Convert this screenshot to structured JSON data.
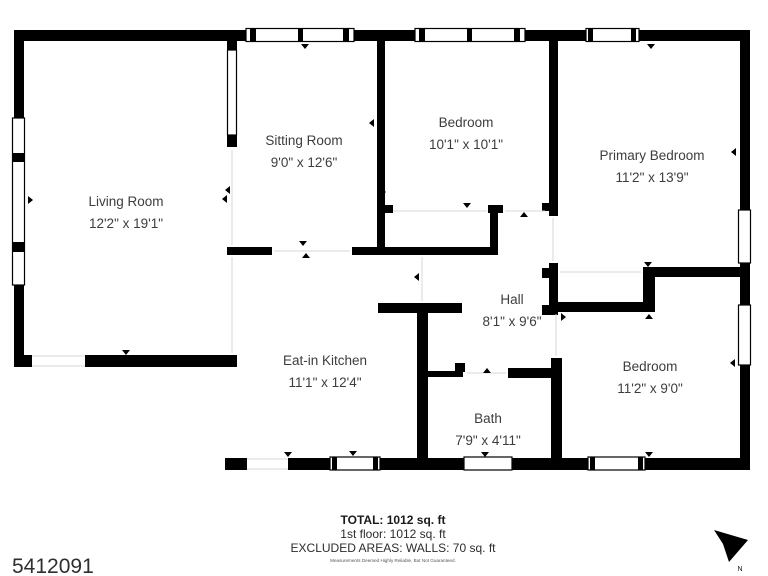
{
  "plan": {
    "rooms": [
      {
        "name": "Living Room",
        "dims": "12'2\" x 19'1\""
      },
      {
        "name": "Sitting Room",
        "dims": "9'0\" x 12'6\""
      },
      {
        "name": "Bedroom",
        "dims": "10'1\" x 10'1\""
      },
      {
        "name": "Primary Bedroom",
        "dims": "11'2\" x 13'9\""
      },
      {
        "name": "Hall",
        "dims": "8'1\" x 9'6\""
      },
      {
        "name": "Eat-in Kitchen",
        "dims": "11'1\" x 12'4\""
      },
      {
        "name": "Bath",
        "dims": "7'9\" x 4'11\""
      },
      {
        "name": "Bedroom",
        "dims": "11'2\" x 9'0\""
      }
    ]
  },
  "footer": {
    "total": "TOTAL: 1012 sq. ft",
    "first_floor": "1st floor: 1012 sq. ft",
    "excluded": "EXCLUDED AREAS: WALLS: 70 sq. ft",
    "disclaimer": "Measurements Deemed Highly Reliable, But Not Guaranteed."
  },
  "listing_id": "5412091",
  "compass": {
    "label": "N"
  },
  "colors": {
    "wall": "#000000",
    "label_text": "#3d3d3d"
  }
}
